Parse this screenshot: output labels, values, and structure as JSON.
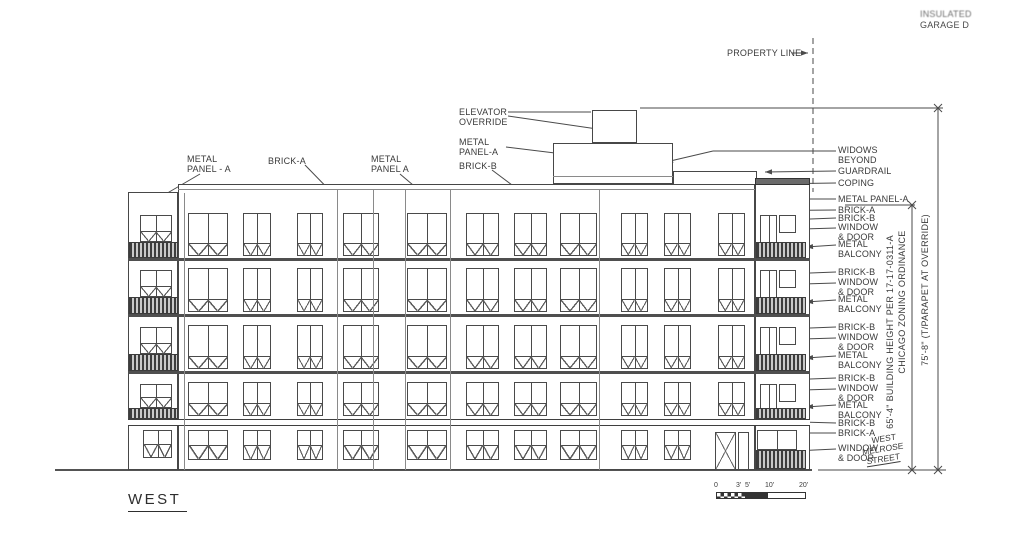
{
  "drawing_title": "WEST",
  "notes": {
    "top_right_line1": "INSULATED",
    "top_right_line2": "GARAGE D",
    "property_line": "PROPERTY LINE"
  },
  "callouts_left": [
    {
      "line1": "METAL",
      "line2": "PANEL - A"
    },
    {
      "line1": "BRICK-A"
    },
    {
      "line1": "METAL",
      "line2": "PANEL A"
    }
  ],
  "callouts_mid": [
    {
      "line1": "ELEVATOR",
      "line2": "OVERRIDE"
    },
    {
      "line1": "METAL",
      "line2": "PANEL-A"
    },
    {
      "line1": "BRICK-B"
    }
  ],
  "callouts_right": [
    {
      "line1": "WIDOWS",
      "line2": "BEYOND"
    },
    {
      "line1": "GUARDRAIL"
    },
    {
      "line1": "COPING"
    },
    {
      "line1": "METAL PANEL-A"
    },
    {
      "line1": "BRICK-A"
    },
    {
      "line1": "BRICK-B"
    },
    {
      "line1": "WINDOW",
      "line2": "& DOOR"
    },
    {
      "line1": "METAL",
      "line2": "BALCONY"
    },
    {
      "line1": "BRICK-B"
    },
    {
      "line1": "WINDOW",
      "line2": "& DOOR"
    },
    {
      "line1": "METAL",
      "line2": "BALCONY"
    },
    {
      "line1": "BRICK-B"
    },
    {
      "line1": "WINDOW",
      "line2": "& DOOR"
    },
    {
      "line1": "METAL",
      "line2": "BALCONY"
    },
    {
      "line1": "BRICK-B"
    },
    {
      "line1": "WINDOW",
      "line2": "& DOOR"
    },
    {
      "line1": "METAL",
      "line2": "BALCONY"
    },
    {
      "line1": "BRICK-B"
    },
    {
      "line1": "BRICK-A"
    },
    {
      "line1": "WINDOW",
      "line2": "& DOOR"
    }
  ],
  "dimensions": {
    "building_height": "65'-4\" BUILDING HEIGHT PER 17-17-0311-A",
    "zoning_ordinance": "CHICAGO ZONING ORDINANCE",
    "parapet_height": "75'-8\" (T/PARAPET AT OVERRIDE)"
  },
  "street_label": {
    "line1": "WEST",
    "line2": "MELROSE",
    "line3": "STREET"
  },
  "scale_bar_labels": [
    "0",
    "3'",
    "5'",
    "10'",
    "20'"
  ],
  "colors": {
    "line": "#4a4a4a",
    "text": "#3a3a3a",
    "hatch": "#3d3d3d"
  }
}
